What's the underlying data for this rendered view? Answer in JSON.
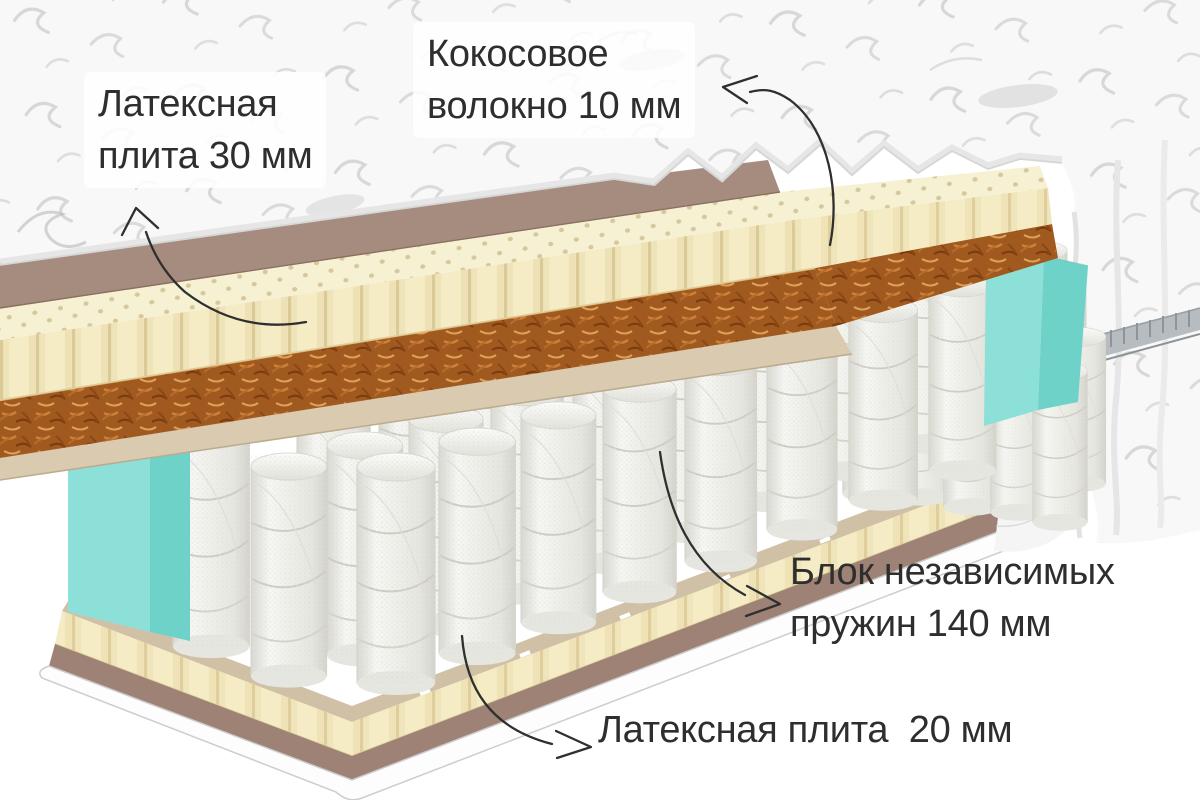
{
  "page": {
    "width": 1200,
    "height": 800,
    "background": "#ffffff",
    "language": "ru"
  },
  "callouts": {
    "latex_top": {
      "lines": [
        "Латексная",
        "плита 30 мм"
      ]
    },
    "coconut": {
      "lines": [
        "Кокосовое",
        "волокно 10 мм"
      ]
    },
    "springs": {
      "lines": [
        "Блок независимых",
        "пружин 140 мм"
      ]
    },
    "latex_bottom": {
      "lines": [
        "Латексная плита  20 мм"
      ]
    }
  },
  "colors": {
    "c_page": "#ffffff",
    "c_cover": "#f8f8f8",
    "c_cover_line": "#d6d6d6",
    "c_underside": "#a68c7f",
    "c_latex": "#f5ecc5",
    "c_latex_top": "#f7f1d3",
    "c_coir": "#a05a20",
    "c_board": "#d9cab0",
    "c_felt": "#cfc0a6",
    "c_foam_front": "#8de0d8",
    "c_foam_side": "#6fd2c9",
    "c_base_mauve": "#9e8275",
    "c_base_white": "#fdfdfd",
    "c_zipper": "#b6bcc0",
    "c_text": "#2e2e2e",
    "c_arrow": "#2f2f2f"
  }
}
